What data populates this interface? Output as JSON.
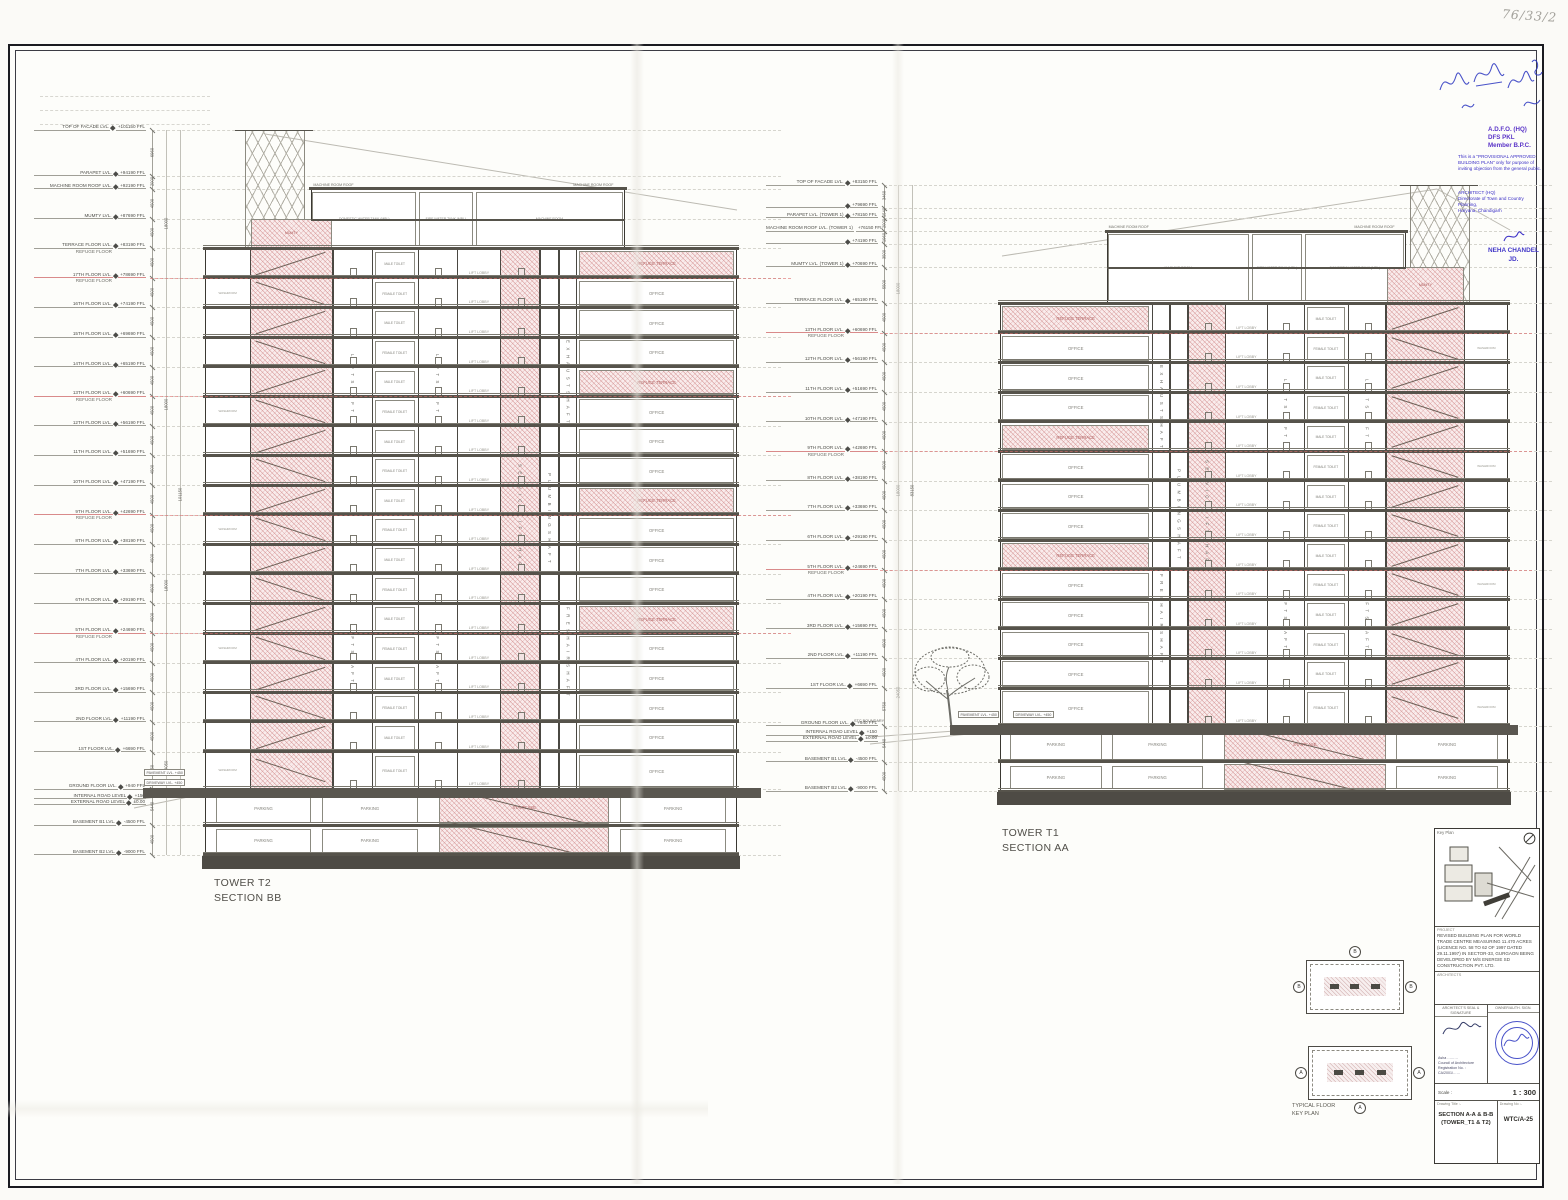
{
  "document": {
    "handwritten_note": "76/33/2"
  },
  "stamps": {
    "ink": "#2a35c0",
    "approver_lines": [
      "A.D.F.O. (HQ)",
      "DFS PKL",
      "Member B.P.C."
    ],
    "provisional_text": "This is a \"PROVISIONAL APPROVED BUILDING PLAN\" only for purpose of inviting objection from the general public.",
    "office_lines": [
      "ARCHITECT (HQ)",
      "Directorate of Town and Country Planning,",
      "Haryana, Chandigarh"
    ],
    "signatory_name": "NEHA CHANDEL",
    "signatory_designation": "JD."
  },
  "title_block": {
    "key_plan_label": "Key Plan",
    "project_label": "PROJECT",
    "project_text": "REVISED BUILDING PLAN FOR WORLD TRADE CENTRE MEASURING 11.470 ACRES (LICENCE NO. 58 TO 62 OF 1997 DATED 29.11.1997) IN SECTOR-33, GURGAON BEING DEVELOPED BY M/S ENERGIE SD CONSTRUCTION PVT. LTD.",
    "architects_label": "ARCHITECTS",
    "seal_label": "ARCHITECT'S SEAL & SIGNATURE",
    "owner_label": "OWNER/AUTH. SIGN.",
    "architect_lines": [
      "Asha ………",
      "Council of Architecture",
      "Registration No. : CA/2001/……"
    ],
    "scale_label": "Scale :",
    "scale_value": "1 : 300",
    "drawing_title_label": "Drawing Title :-",
    "drawing_title": "SECTION A-A & B-B (TOWER_T1 & T2)",
    "drawing_no_label": "Drawing No :-",
    "drawing_no": "WTC/A-25"
  },
  "typical_plan": {
    "caption_line1": "TYPICAL FLOOR",
    "caption_line2": "KEY PLAN",
    "marker_top": "B",
    "marker_bottom": "A"
  },
  "site": {
    "boundary": "STC BOUNDARY",
    "pavement": "PAVEMENT LVL. +450",
    "driveway": "DRIVEWAY LVL. +450"
  },
  "towers": [
    {
      "id": "T2",
      "title": "TOWER T2",
      "section": "SECTION BB",
      "shafts": {
        "lift": "LIFT SHAFT",
        "service": "SERVICE LIFT SHAFT",
        "plumbing": "PLUMBING SHAFT",
        "exhaust": "EXHAUST SHAFT",
        "fresh": "FRESH AIR SHAFT"
      },
      "rooms": {
        "office": "OFFICE",
        "refuge": "REFUGE TERRACE",
        "lobby": "LIFT LOBBY",
        "toilet_m": "MALE TOILET",
        "toilet_f": "FEMALE TOILET",
        "washroom": "WASHROOM",
        "machine": "MACHINE ROOM",
        "machine_roof": "MACHINE ROOM ROOF",
        "mumty": "MUMTY",
        "dwt": "DOMESTIC WATER TANK (MBL)",
        "fwt": "FIRE WATER TANK (MBL)",
        "parking": "PARKING",
        "staircase": "STAIRCASE"
      },
      "dims": {
        "groups": [
          "18000",
          "18000",
          "18000",
          "24050"
        ],
        "total": "101150"
      },
      "levels": [
        {
          "l": "TOP OF FACADE LVL.",
          "v": "+101150 FFL",
          "f": 101150
        },
        {
          "l": "PARAPET LVL.",
          "v": "+94190 FFL",
          "f": 94190
        },
        {
          "l": "MACHINE ROOM ROOF LVL.",
          "v": "+92190 FFL",
          "f": 92190
        },
        {
          "l": "MUMTY LVL.",
          "v": "+87690 FFL",
          "f": 87690
        },
        {
          "l": "TERRACE FLOOR LVL.",
          "sub": "REFUGE FLOOR",
          "v": "+83190 FFL",
          "f": 83190,
          "s": 1
        },
        {
          "l": "17TH FLOOR LVL.",
          "sub": "REFUGE FLOOR",
          "v": "+78690 FFL",
          "f": 78690,
          "s": 1,
          "r": 1
        },
        {
          "l": "16TH FLOOR LVL.",
          "v": "+74190 FFL",
          "f": 74190,
          "s": 1
        },
        {
          "l": "15TH FLOOR LVL.",
          "v": "+69690 FFL",
          "f": 69690,
          "s": 1
        },
        {
          "l": "14TH FLOOR LVL.",
          "v": "+65190 FFL",
          "f": 65190,
          "s": 1
        },
        {
          "l": "13TH FLOOR LVL.",
          "sub": "REFUGE FLOOR",
          "v": "+60690 FFL",
          "f": 60690,
          "s": 1,
          "r": 1
        },
        {
          "l": "12TH FLOOR LVL.",
          "v": "+56190 FFL",
          "f": 56190,
          "s": 1
        },
        {
          "l": "11TH FLOOR LVL.",
          "v": "+51690 FFL",
          "f": 51690,
          "s": 1
        },
        {
          "l": "10TH FLOOR LVL.",
          "v": "+47190 FFL",
          "f": 47190,
          "s": 1
        },
        {
          "l": "9TH FLOOR LVL.",
          "sub": "REFUGE FLOOR",
          "v": "+42690 FFL",
          "f": 42690,
          "s": 1,
          "r": 1
        },
        {
          "l": "8TH FLOOR LVL.",
          "v": "+38190 FFL",
          "f": 38190,
          "s": 1
        },
        {
          "l": "7TH FLOOR LVL.",
          "v": "+33690 FFL",
          "f": 33690,
          "s": 1
        },
        {
          "l": "6TH FLOOR LVL.",
          "v": "+29190 FFL",
          "f": 29190,
          "s": 1
        },
        {
          "l": "5TH FLOOR LVL.",
          "sub": "REFUGE FLOOR",
          "v": "+24690 FFL",
          "f": 24690,
          "s": 1,
          "r": 1
        },
        {
          "l": "4TH FLOOR LVL.",
          "v": "+20190 FFL",
          "f": 20190,
          "s": 1
        },
        {
          "l": "3RD FLOOR LVL.",
          "v": "+15690 FFL",
          "f": 15690,
          "s": 1
        },
        {
          "l": "2ND FLOOR LVL.",
          "v": "+11190 FFL",
          "f": 11190,
          "s": 1
        },
        {
          "l": "1ST FLOOR LVL.",
          "v": "+6690 FFL",
          "f": 6690,
          "s": 1
        },
        {
          "l": "GROUND FLOOR LVL.",
          "v": "+940 FFL",
          "f": 940,
          "s": 1
        },
        {
          "l": "INTERNAL ROAD LEVEL",
          "v": "+150",
          "f": 150,
          "road": 1
        },
        {
          "l": "EXTERNAL ROAD LEVEL",
          "v": "±0.00",
          "f": 0,
          "road": 1
        },
        {
          "l": "BASEMENT B1 LVL.",
          "v": "-4500 FFL",
          "f": -4500,
          "s": 1,
          "b": 1
        },
        {
          "l": "BASEMENT B2 LVL.",
          "v": "-9000 FFL",
          "f": -9000,
          "s": 1,
          "b": 1
        }
      ]
    },
    {
      "id": "T1",
      "title": "TOWER T1",
      "section": "SECTION AA",
      "shafts": {
        "lift": "LIFT SHAFT",
        "service": "SERVICE LIFT SHAFT",
        "plumbing": "PLUMBING SHAFT",
        "exhaust": "EXHAUST SHAFT",
        "fresh": "FRESH AIR SHAFT"
      },
      "rooms": {
        "office": "OFFICE",
        "refuge": "REFUGE TERRACE",
        "lobby": "LIFT LOBBY",
        "toilet_m": "MALE TOILET",
        "toilet_f": "FEMALE TOILET",
        "washroom": "WASHROOM",
        "machine": "MACHINE ROOM",
        "machine_roof": "MACHINE ROOM ROOF",
        "mumty": "MUMTY",
        "dwt": "DOMESTIC WATER TANK (MBL)",
        "fwt": "FIRE WATER TANK (MBL)",
        "parking": "PARKING",
        "staircase": "STAIRCASE"
      },
      "dims": {
        "groups": [
          "18000",
          "18000",
          "24050"
        ],
        "total": "83150"
      },
      "levels": [
        {
          "l": "TOP OF FACADE LVL.",
          "v": "+83150 FFL",
          "f": 83150
        },
        {
          "l": "",
          "v": "+79690 FFL",
          "f": 79690
        },
        {
          "l": "PARAPET LVL. (TOWER 1)",
          "v": "+78150 FFL",
          "f": 78150
        },
        {
          "l": "MACHINE ROOM ROOF LVL. (TOWER 1)",
          "v": "+76150 FFL",
          "f": 76150
        },
        {
          "l": "",
          "v": "+74190 FFL",
          "f": 74190
        },
        {
          "l": "MUMTY LVL. (TOWER 1)",
          "v": "+70690 FFL",
          "f": 70690
        },
        {
          "l": "TERRACE FLOOR LVL.",
          "v": "+65190 FFL",
          "f": 65190,
          "s": 1
        },
        {
          "l": "13TH FLOOR LVL.",
          "sub": "REFUGE FLOOR",
          "v": "+60690 FFL",
          "f": 60690,
          "s": 1,
          "r": 1
        },
        {
          "l": "12TH FLOOR LVL.",
          "v": "+56190 FFL",
          "f": 56190,
          "s": 1
        },
        {
          "l": "11TH FLOOR LVL.",
          "v": "+51690 FFL",
          "f": 51690,
          "s": 1
        },
        {
          "l": "10TH FLOOR LVL.",
          "v": "+47190 FFL",
          "f": 47190,
          "s": 1
        },
        {
          "l": "9TH FLOOR LVL.",
          "sub": "REFUGE FLOOR",
          "v": "+42690 FFL",
          "f": 42690,
          "s": 1,
          "r": 1
        },
        {
          "l": "8TH FLOOR LVL.",
          "v": "+38190 FFL",
          "f": 38190,
          "s": 1
        },
        {
          "l": "7TH FLOOR LVL.",
          "v": "+33690 FFL",
          "f": 33690,
          "s": 1
        },
        {
          "l": "6TH FLOOR LVL.",
          "v": "+29190 FFL",
          "f": 29190,
          "s": 1
        },
        {
          "l": "5TH FLOOR LVL.",
          "sub": "REFUGE FLOOR",
          "v": "+24690 FFL",
          "f": 24690,
          "s": 1,
          "r": 1
        },
        {
          "l": "4TH FLOOR LVL.",
          "v": "+20190 FFL",
          "f": 20190,
          "s": 1
        },
        {
          "l": "3RD FLOOR LVL.",
          "v": "+15690 FFL",
          "f": 15690,
          "s": 1
        },
        {
          "l": "2ND FLOOR LVL.",
          "v": "+11190 FFL",
          "f": 11190,
          "s": 1
        },
        {
          "l": "1ST FLOOR LVL.",
          "v": "+6690 FFL",
          "f": 6690,
          "s": 1
        },
        {
          "l": "GROUND FLOOR LVL.",
          "v": "+940 FFL",
          "f": 940,
          "s": 1
        },
        {
          "l": "INTERNAL ROAD LEVEL",
          "v": "+150",
          "f": 150,
          "road": 1
        },
        {
          "l": "EXTERNAL ROAD LEVEL",
          "v": "±0.00",
          "f": 0,
          "road": 1
        },
        {
          "l": "BASEMENT B1 LVL.",
          "v": "-4500 FFL",
          "f": -4500,
          "s": 1,
          "b": 1
        },
        {
          "l": "BASEMENT B2 LVL.",
          "v": "-9000 FFL",
          "f": -9000,
          "s": 1,
          "b": 1
        }
      ]
    }
  ]
}
